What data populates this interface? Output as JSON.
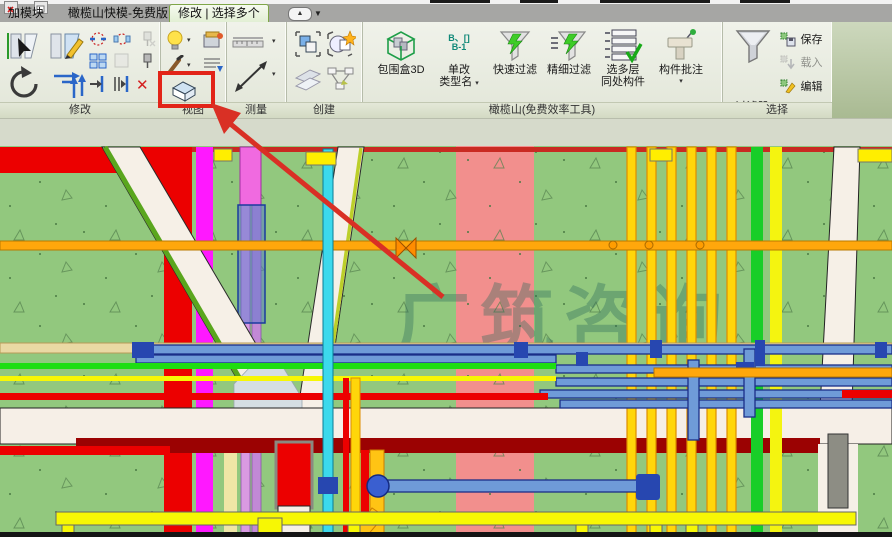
{
  "tabs": [
    {
      "label": "加模块",
      "active": false
    },
    {
      "label": "橄榄山快模-免费版",
      "active": false
    },
    {
      "label": "修改 | 选择多个",
      "active": true
    }
  ],
  "glyphs": {
    "dropdown": "▾",
    "collapse": "▲",
    "caret": "▼",
    "delete": "✕"
  },
  "panels": {
    "modify": {
      "label": "修改"
    },
    "view": {
      "label": "视图"
    },
    "measure": {
      "label": "测量"
    },
    "create": {
      "label": "创建"
    },
    "olive": {
      "label": "橄榄山(免费效率工具)",
      "rename_icon_text1": "B、[]",
      "rename_icon_text2": "B-1",
      "buttons": [
        {
          "line1": "包围盒3D",
          "line2": ""
        },
        {
          "line1": "单改",
          "line2": "类型名"
        },
        {
          "line1": "快速过滤",
          "line2": ""
        },
        {
          "line1": "精细过滤",
          "line2": ""
        },
        {
          "line1": "选多层",
          "line2": "同处构件"
        },
        {
          "line1": "构件批注",
          "line2": "▾"
        }
      ]
    },
    "selection": {
      "label": "选择",
      "filter_label": "过滤器",
      "buttons": [
        {
          "label": "保存",
          "enabled": true
        },
        {
          "label": "载入",
          "enabled": false
        },
        {
          "label": "编辑",
          "enabled": true
        }
      ]
    }
  },
  "canvas": {
    "watermark": "广筑咨询"
  }
}
